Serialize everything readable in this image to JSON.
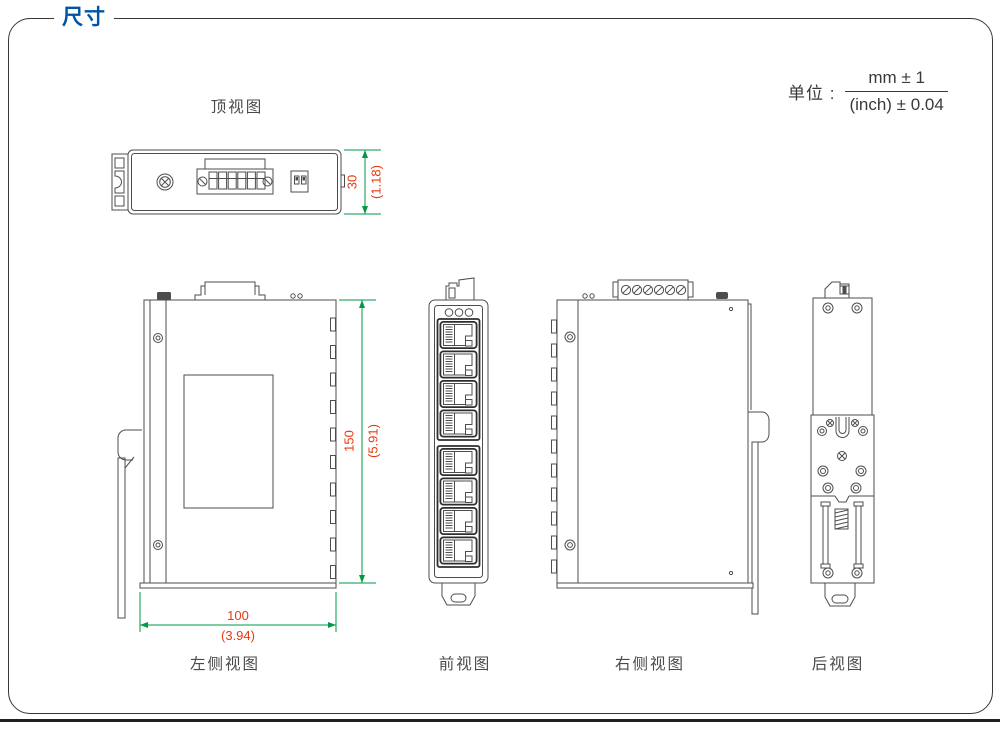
{
  "page": {
    "title": "尺寸",
    "unit": {
      "label": "单位 :",
      "numerator": "mm ± 1",
      "denominator": "(inch) ± 0.04"
    }
  },
  "views": {
    "top": {
      "label": "顶视图",
      "dim_height": {
        "mm": "30",
        "inch": "(1.18)"
      }
    },
    "left": {
      "label": "左侧视图",
      "dim_height": {
        "mm": "150",
        "inch": "(5.91)"
      },
      "dim_width": {
        "mm": "100",
        "inch": "(3.94)"
      }
    },
    "front": {
      "label": "前视图"
    },
    "right": {
      "label": "右侧视图"
    },
    "back": {
      "label": "后视图"
    }
  },
  "colors": {
    "accent_blue": "#0054a6",
    "dimension_line_green": "#009944",
    "dimension_text_red": "#e8380d",
    "drawing_line_gray": "#4d4d4d",
    "bottom_bar": "#231f20"
  }
}
